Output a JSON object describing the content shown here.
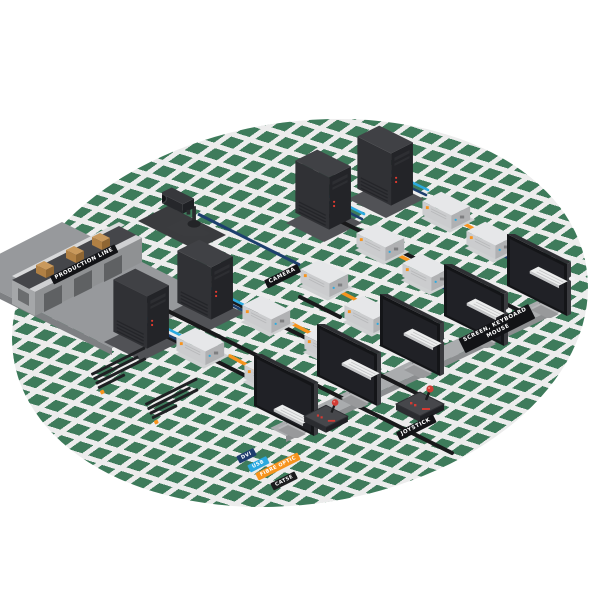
{
  "banners": {
    "production_line": "PRODUCTION LINE",
    "camera": "CAMERA",
    "screen_keyboard_line1": "SCREEN, KEYBOARD",
    "screen_keyboard_line2": "MOUSE",
    "joystick": "JOYSTICK"
  },
  "legend": {
    "items": [
      {
        "id": "dvi",
        "label": "DVI",
        "color": "#1e3c6e"
      },
      {
        "id": "usb",
        "label": "USB",
        "color": "#2aa9e0"
      },
      {
        "id": "fibre",
        "label": "FIBRE OPTIC",
        "color": "#f7941e"
      },
      {
        "id": "cat",
        "label": "CAT5E",
        "color": "#1c1c1e"
      }
    ]
  },
  "colors": {
    "floor_green": "#3e7b5b",
    "lattice": "#ececec",
    "cable_dvi": "#1d3f6e",
    "cable_usb": "#2aa9e0",
    "cable_fibre": "#f7941e",
    "cable_network": "#19191b"
  }
}
